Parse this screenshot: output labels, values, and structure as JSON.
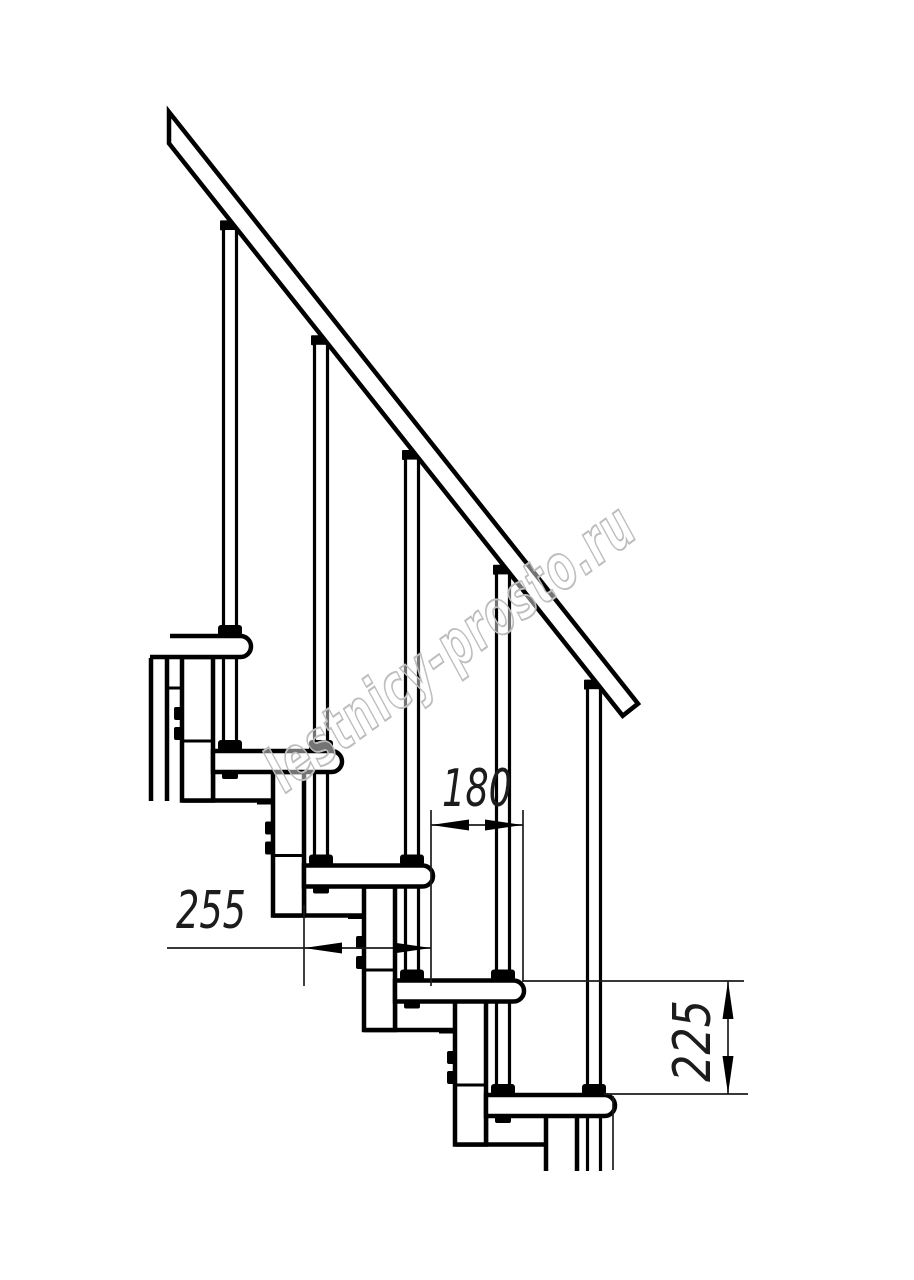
{
  "title": "Modular staircase side elevation drawing",
  "watermark": {
    "text": "lestnicy-prosto.ru"
  },
  "dimensions": {
    "tread_depth": {
      "value": "255"
    },
    "step_run": {
      "value": "180"
    },
    "step_rise": {
      "value": "225"
    }
  },
  "colors": {
    "line": "#000000",
    "dimension_line": "#1c1c1c",
    "watermark_stroke": "#bdbdbd",
    "background": "#ffffff"
  }
}
